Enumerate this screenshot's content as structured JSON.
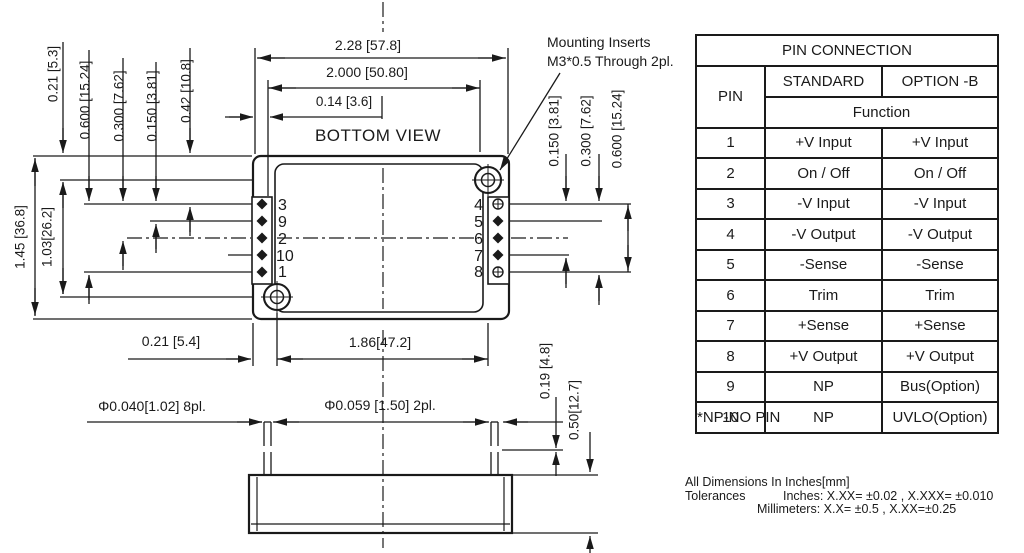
{
  "colors": {
    "ink": "#1a1a1a",
    "bg": "#ffffff"
  },
  "drawing": {
    "view_label": "BOTTOM VIEW",
    "mounting_note": {
      "line1": "Mounting Inserts",
      "line2": "M3*0.5 Through 2pl."
    },
    "pins": {
      "left": [
        "3",
        "9",
        "2",
        "10",
        "1"
      ],
      "right": [
        "4",
        "5",
        "6",
        "7",
        "8"
      ]
    },
    "dims": {
      "body_width": "2.28 [57.8]",
      "pin_span_x": "2.000 [50.80]",
      "pin_edge_x": "0.14 [3.6]",
      "edge_to_hole_y": "0.21 [5.3]",
      "pin_span_y": "0.600 [15.24]",
      "pin_pitch_2x": "0.300 [7.62]",
      "pin_pitch": "0.150 [3.81]",
      "edge_to_pin_y": "0.42 [10.8]",
      "body_height": "1.45 [36.8]",
      "hole_span_y": "1.03[26.2]",
      "right_pitch": "0.150 [3.81]",
      "right_pitch_2x": "0.300 [7.62]",
      "right_span": "0.600 [15.24]",
      "edge_to_hole_x": "0.21 [5.4]",
      "hole_span_x": "1.86[47.2]",
      "pin_dia": "Φ0.040[1.02] 8pl.",
      "insert_dia": "Φ0.059 [1.50] 2pl.",
      "pin_step": "0.19 [4.8]",
      "pin_length": "0.50[12.7]"
    }
  },
  "table": {
    "title": "PIN CONNECTION",
    "col_pin": "PIN",
    "col_standard": "STANDARD",
    "col_option": "OPTION -B",
    "function_label": "Function",
    "rows": [
      {
        "pin": "1",
        "standard": "+V Input",
        "option": "+V Input"
      },
      {
        "pin": "2",
        "standard": "On / Off",
        "option": "On / Off"
      },
      {
        "pin": "3",
        "standard": "-V Input",
        "option": "-V Input"
      },
      {
        "pin": "4",
        "standard": "-V Output",
        "option": "-V Output"
      },
      {
        "pin": "5",
        "standard": "-Sense",
        "option": "-Sense"
      },
      {
        "pin": "6",
        "standard": "Trim",
        "option": "Trim"
      },
      {
        "pin": "7",
        "standard": "+Sense",
        "option": "+Sense"
      },
      {
        "pin": "8",
        "standard": "+V Output",
        "option": "+V Output"
      },
      {
        "pin": "9",
        "standard": "NP",
        "option": "Bus(Option)"
      },
      {
        "pin": "10",
        "standard": "NP",
        "option": "UVLO(Option)"
      }
    ]
  },
  "notes": {
    "np": "*NP-NO PIN",
    "dims": "All Dimensions In Inches[mm]",
    "tol_label": "Tolerances",
    "tol_inches": "Inches: X.XX= ±0.02 , X.XXX= ±0.010",
    "tol_mm": "Millimeters: X.X= ±0.5 , X.XX=±0.25"
  }
}
